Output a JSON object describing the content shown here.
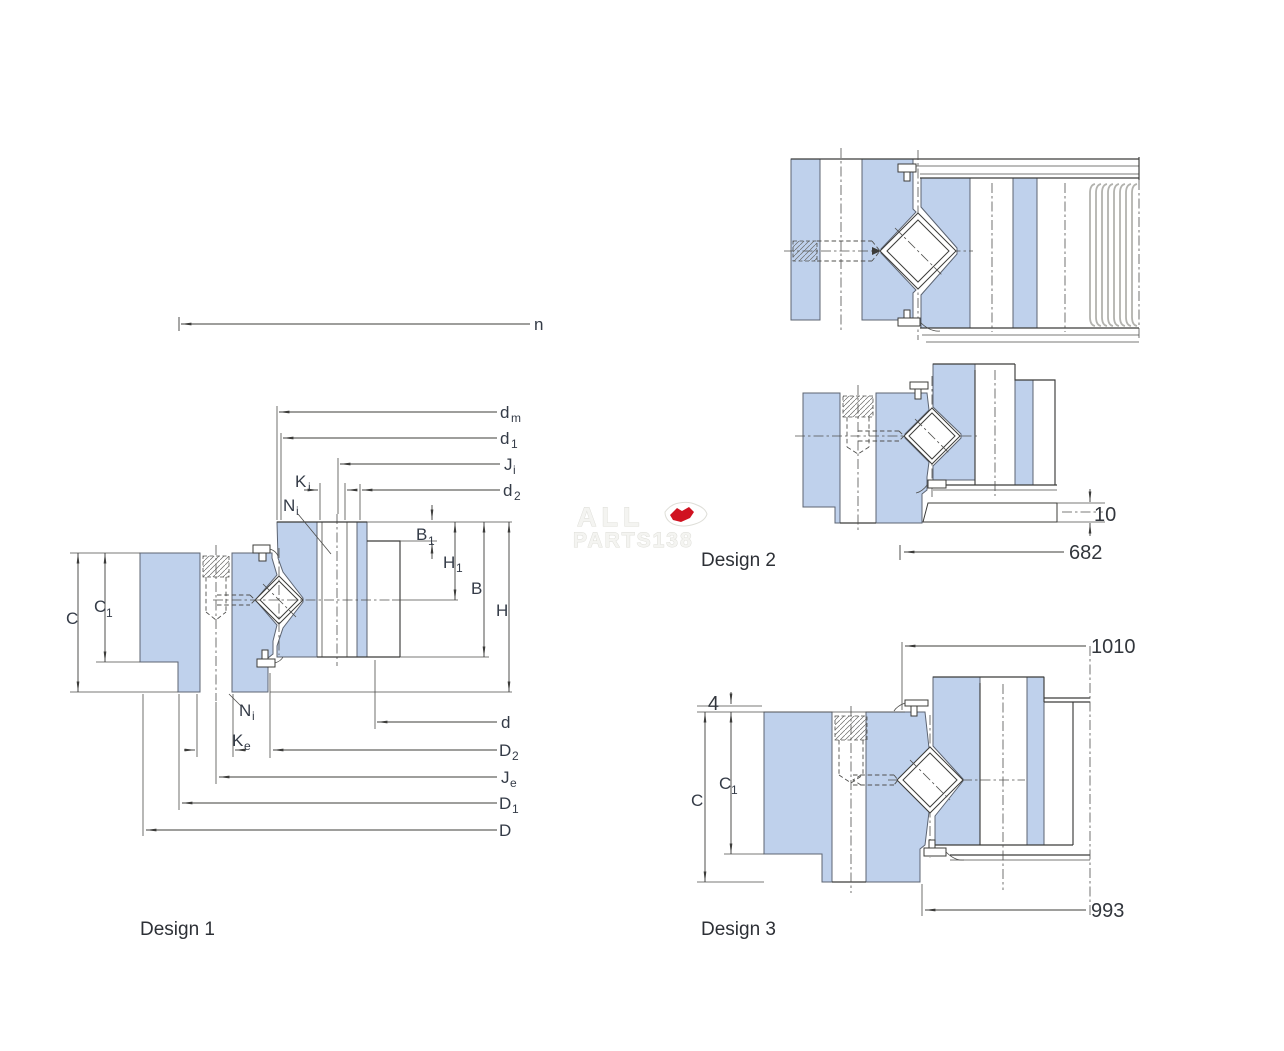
{
  "colors": {
    "part_fill": "#bfd1ec",
    "line": "#3c3c3a",
    "label": "#343b47",
    "gear_line": "#b2b2ae",
    "watermark_red": "#d01220"
  },
  "watermark": {
    "line1": "ALL",
    "line2": "PARTS138"
  },
  "designs": {
    "d1": {
      "caption": "Design 1",
      "n": "n",
      "dm_b": "d",
      "dm_s": "m",
      "d1_b": "d",
      "d1_s": "1",
      "Ji_b": "J",
      "Ji_s": "i",
      "d2_b": "d",
      "d2_s": "2",
      "Ki_b": "K",
      "Ki_s": "i",
      "Ni_b": "N",
      "Ni_s": "i",
      "B1_b": "B",
      "B1_s": "1",
      "H1_b": "H",
      "H1_s": "1",
      "B": "B",
      "H": "H",
      "C": "C",
      "C1_b": "C",
      "C1_s": "1",
      "Ni2_b": "N",
      "Ni2_s": "i",
      "Ke_b": "K",
      "Ke_s": "e",
      "d": "d",
      "D2_b": "D",
      "D2_s": "2",
      "Je_b": "J",
      "Je_s": "e",
      "D1_b": "D",
      "D1_s": "1",
      "D": "D"
    },
    "d2": {
      "caption": "Design 2",
      "plate_thickness": "10",
      "base_diameter": "682"
    },
    "d3": {
      "caption": "Design 3",
      "top_diameter": "1010",
      "offset": "4",
      "C": "C",
      "C1_b": "C",
      "C1_s": "1",
      "bottom_diameter": "993"
    }
  }
}
